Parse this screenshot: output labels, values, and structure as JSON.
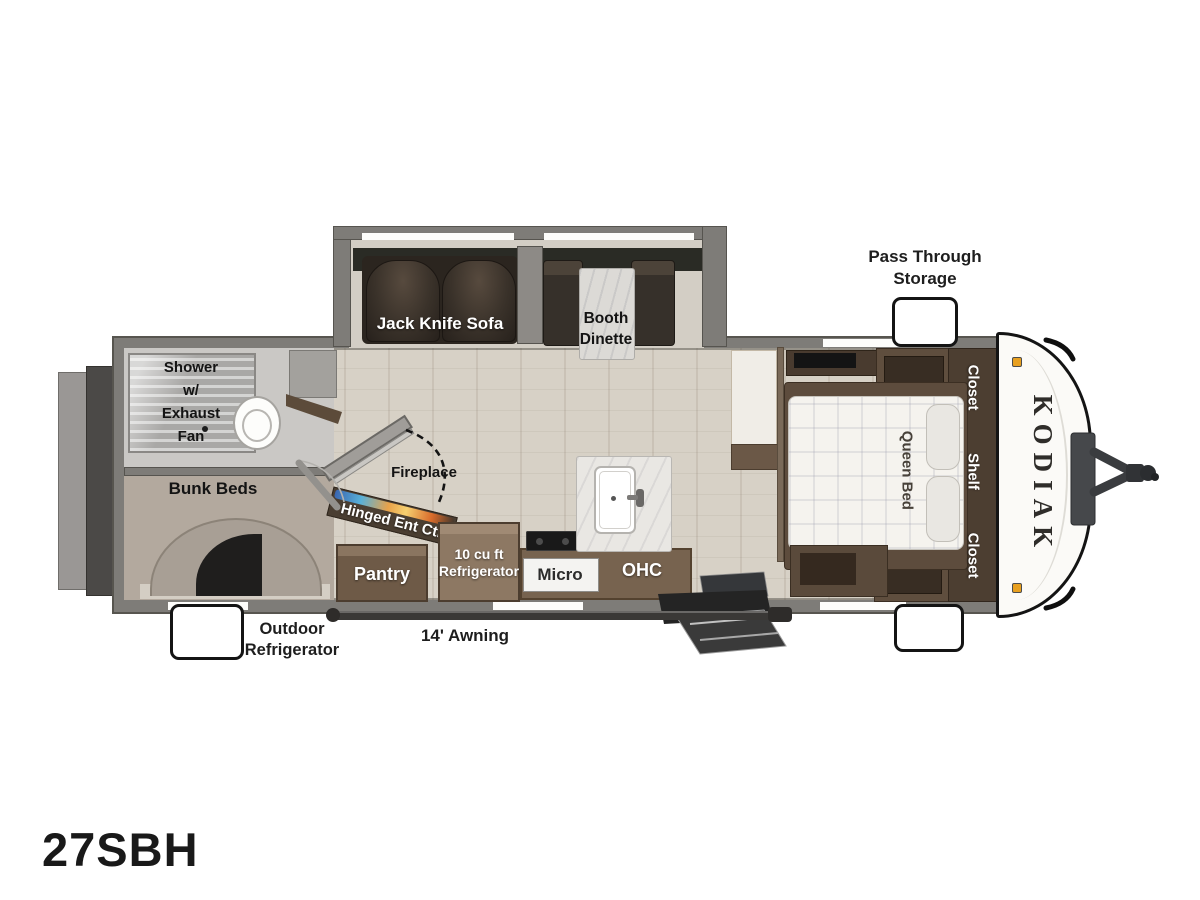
{
  "model": "27SBH",
  "brand": "KODIAK",
  "exterior": {
    "pass_through_line1": "Pass Through",
    "pass_through_line2": "Storage",
    "outdoor_fridge_line1": "Outdoor",
    "outdoor_fridge_line2": "Refrigerator",
    "awning": "14' Awning"
  },
  "living_area": {
    "sofa": "Jack Knife Sofa",
    "dinette_line1": "Booth",
    "dinette_line2": "Dinette",
    "fireplace": "Fireplace",
    "entertainment_center": "Hinged Ent Ctr"
  },
  "kitchen": {
    "pantry": "Pantry",
    "refrigerator_line1": "10 cu ft",
    "refrigerator_line2": "Refrigerator",
    "microwave": "Micro",
    "overhead_cabinet": "OHC"
  },
  "bathroom": {
    "shower_line1": "Shower",
    "shower_line2": "w/",
    "shower_line3": "Exhaust",
    "shower_line4": "Fan"
  },
  "bunk_room": {
    "label": "Bunk Beds"
  },
  "bedroom": {
    "bed": "Queen Bed",
    "closet_front": "Closet",
    "shelf": "Shelf",
    "closet_rear": "Closet"
  },
  "colors": {
    "wall_gray": "#7e7c78",
    "floor_wood": "#d7d1c6",
    "cabinet_brown": "#77634f",
    "dark_furniture": "#4c3e31",
    "carpet": "#b3a99e",
    "marker_light": "#e8a020",
    "flame_orange": "#e8862a",
    "flame_blue": "#4a7ec0"
  }
}
